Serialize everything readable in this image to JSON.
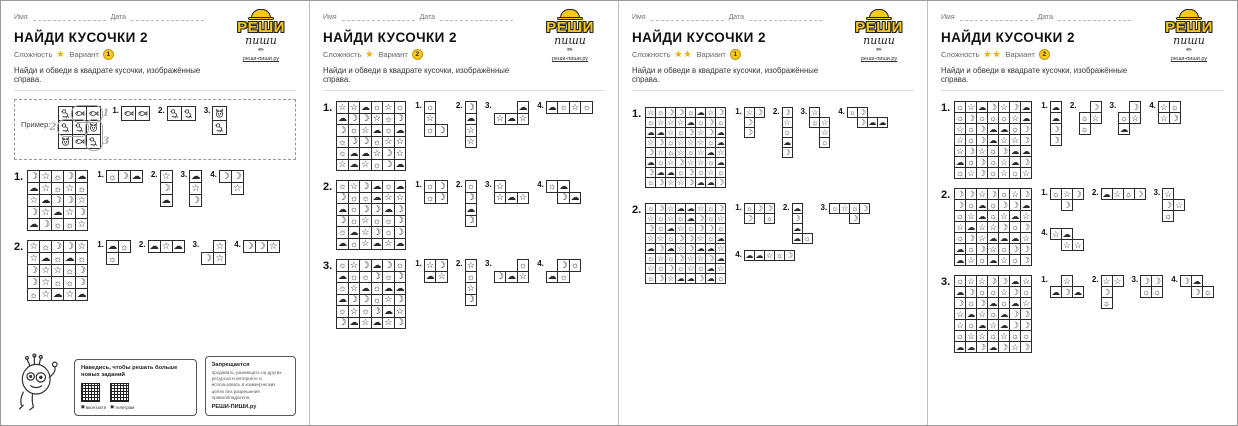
{
  "symbol_chars": {
    "M": "☽",
    "S": "☆",
    "U": "☼",
    "C": "☁"
  },
  "symbol_names": {
    "M": "moon-icon",
    "S": "star-icon",
    "U": "sun-icon",
    "C": "cloud-icon",
    "B": "bird-icon",
    "F": "fish-icon",
    "K": "cat-icon"
  },
  "logo": {
    "line1": "РЕШИ",
    "line2": "пиши",
    "site": "реши-пиши.ру"
  },
  "footer": {
    "promo_title": "Наведись, чтобы решать больше новых заданий",
    "qr1_label": "вконтакте",
    "qr2_label": "телеграм",
    "rights_title": "Запрещается",
    "rights_text": "продавать, размещать на других ресурсах в интернете и использовать в коммерческих целях без разрешения правообладателя.",
    "rights_brand": "РЕШИ-ПИШИ.ру"
  },
  "pages": [
    {
      "name_label": "Имя",
      "date_label": "Дата",
      "title": "НАЙДИ КУСОЧКИ 2",
      "difficulty_label": "Сложность",
      "difficulty_stars": "★",
      "variant_label": "Вариант",
      "variant": "1",
      "instruction": "Найди и обведи в квадрате кусочки, изображённые справа.",
      "example": {
        "label": "Пример:",
        "grid": [
          "BFF",
          "BBK",
          "KFB"
        ],
        "pieces": [
          {
            "n": "1.",
            "rows": [
              "FF"
            ]
          },
          {
            "n": "2.",
            "rows": [
              "BB"
            ]
          },
          {
            "n": "3.",
            "rows": [
              "K",
              "B"
            ]
          }
        ],
        "circles": [
          {
            "r": 0,
            "c": 1,
            "w": 2,
            "h": 1,
            "label": "1",
            "side": "right"
          },
          {
            "r": 1,
            "c": 0,
            "w": 2,
            "h": 1,
            "label": "2",
            "side": "left"
          },
          {
            "r": 1,
            "c": 2,
            "w": 1,
            "h": 2,
            "label": "3",
            "side": "right"
          }
        ]
      },
      "has_footer": true,
      "puzzles": [
        {
          "n": "1.",
          "grid": [
            "MSUMC",
            "CSUSU",
            "SCMMS",
            "MSCSM",
            "CMUUS"
          ],
          "pieces": [
            {
              "n": "1.",
              "rows": [
                "UMC"
              ]
            },
            {
              "n": "2.",
              "rows": [
                "S",
                "M",
                "C"
              ]
            },
            {
              "n": "3.",
              "rows": [
                "C",
                "S",
                "M"
              ]
            },
            {
              "n": "4.",
              "rows": [
                "MM",
                ".S"
              ]
            }
          ]
        },
        {
          "n": "2.",
          "grid": [
            "SUMMS",
            "SCUCU",
            "MSSUM",
            "MSUUM",
            "USCSC"
          ],
          "pieces": [
            {
              "n": "1.",
              "rows": [
                "CU",
                "U."
              ]
            },
            {
              "n": "2.",
              "rows": [
                "CSC"
              ]
            },
            {
              "n": "3.",
              "rows": [
                ".S",
                "MS"
              ]
            },
            {
              "n": "4.",
              "rows": [
                "MMS"
              ]
            }
          ]
        }
      ]
    },
    {
      "name_label": "Имя",
      "date_label": "Дата",
      "title": "НАЙДИ КУСОЧКИ 2",
      "difficulty_label": "Сложность",
      "difficulty_stars": "★",
      "variant_label": "Вариант",
      "variant": "2",
      "instruction": "Найди и обведи в квадрате кусочки, изображённые справа.",
      "has_footer": false,
      "puzzles": [
        {
          "n": "1.",
          "grid": [
            "SSCUSU",
            "CMMSUM",
            "MUSCUC",
            "UMMUSS",
            "UCCSMS",
            "SCSUMC"
          ],
          "pieces": [
            {
              "n": "1.",
              "rows": [
                "U.",
                "S.",
                "UM"
              ]
            },
            {
              "n": "2.",
              "rows": [
                "M",
                "C",
                "S",
                "S"
              ]
            },
            {
              "n": "3.",
              "rows": [
                "..C",
                "SCS"
              ]
            },
            {
              "n": "4.",
              "rows": [
                "CUSU"
              ]
            }
          ]
        },
        {
          "n": "2.",
          "grid": [
            "USMCUC",
            "MUUCSS",
            "CUMMCM",
            "MUSUUM",
            "UCSMUM",
            "CUSCSC"
          ],
          "pieces": [
            {
              "n": "1.",
              "rows": [
                "UM",
                "UM"
              ]
            },
            {
              "n": "2.",
              "rows": [
                "U",
                "M",
                "C",
                "M"
              ]
            },
            {
              "n": "3.",
              "rows": [
                "S..",
                "SCS"
              ]
            },
            {
              "n": "4.",
              "rows": [
                "UC.",
                ".MC"
              ]
            }
          ]
        },
        {
          "n": "3.",
          "grid": [
            "USMCMU",
            "CUUMUM",
            "USCUCC",
            "CMMUSM",
            "USUMCS",
            "MCSCSM"
          ],
          "pieces": [
            {
              "n": "1.",
              "rows": [
                "SM",
                "CS"
              ]
            },
            {
              "n": "2.",
              "rows": [
                "S",
                "U",
                "S",
                "M"
              ]
            },
            {
              "n": "3.",
              "rows": [
                "..U",
                "MCS"
              ]
            },
            {
              "n": "4.",
              "rows": [
                ".MU",
                "CU."
              ]
            }
          ]
        }
      ]
    },
    {
      "name_label": "Имя",
      "date_label": "Дата",
      "title": "НАЙДИ КУСОЧКИ 2",
      "difficulty_label": "Сложность",
      "difficulty_stars": "★★",
      "variant_label": "Вариант",
      "variant": "1",
      "instruction": "Найди и обведи в квадрате кусочки, изображённые справа.",
      "has_footer": false,
      "puzzles": [
        {
          "n": "1.",
          "grid": [
            "SUMMUCSM",
            "USSSCUMU",
            "CCSUMSMC",
            "SMUSSSUC",
            "MSUSUSCS",
            "CUSMSSUC",
            "MCCUMUSU",
            "UMSSMCCM"
          ],
          "pieces": [
            {
              "n": "1.",
              "rows": [
                "SM",
                "M.",
                "M."
              ]
            },
            {
              "n": "2.",
              "rows": [
                "M",
                "S",
                "U",
                "C",
                "M"
              ]
            },
            {
              "n": "3.",
              "rows": [
                "S.",
                "US",
                ".S",
                ".U"
              ]
            },
            {
              "n": "4.",
              "rows": [
                "UM..",
                ".MCC"
              ]
            }
          ]
        },
        {
          "n": "2.",
          "grid": [
            "UMSCCSUM",
            "SUSUCMUS",
            "MUCSUMMU",
            "SSUMMSUC",
            "CMCSMCCS",
            "USUMSSMC",
            "SUMUSUCS",
            "UMSCCMCU"
          ],
          "pieces": [
            {
              "n": "1.",
              "rows": [
                "UMM",
                "M.U"
              ]
            },
            {
              "n": "2.",
              "rows": [
                "C.",
                "M.",
                "C.",
                "CU"
              ]
            },
            {
              "n": "3.",
              "rows": [
                "USUM",
                "..M."
              ]
            },
            {
              "n": "4.",
              "rows": [
                "CCSUM"
              ]
            }
          ]
        }
      ]
    },
    {
      "name_label": "Имя",
      "date_label": "Дата",
      "title": "НАЙДИ КУСОЧКИ 2",
      "difficulty_label": "Сложность",
      "difficulty_stars": "★★",
      "variant_label": "Вариант",
      "variant": "2",
      "instruction": "Найди и обведи в квадрате кусочки, изображённые справа.",
      "has_footer": false,
      "puzzles": [
        {
          "n": "1.",
          "grid": [
            "USCMSMC",
            "UMUUUSC",
            "SUMCCUM",
            "SUMCSSM",
            "SMSUMCC",
            "CUMUSCM",
            "USMUSUS"
          ],
          "pieces": [
            {
              "n": "1.",
              "rows": [
                "C",
                "C",
                "M",
                "M"
              ]
            },
            {
              "n": "2.",
              "rows": [
                ".M",
                "US",
                "U."
              ]
            },
            {
              "n": "3.",
              "rows": [
                ".M",
                "US",
                "C."
              ]
            },
            {
              "n": "4.",
              "rows": [
                "SU",
                "SM"
              ]
            }
          ]
        },
        {
          "n": "2.",
          "grid": [
            "MMSMUSM",
            "MUCUMMC",
            "USCUSCS",
            "SCSSMUM",
            "UMSCCCS",
            "CUMSUMM",
            "CSUCSUM"
          ],
          "pieces": [
            {
              "n": "1.",
              "rows": [
                "USM",
                ".M."
              ]
            },
            {
              "n": "2.",
              "rows": [
                "CSUM"
              ]
            },
            {
              "n": "3.",
              "rows": [
                "S.",
                "MS",
                "U."
              ]
            },
            {
              "n": "4.",
              "rows": [
                "SC.",
                ".SS"
              ]
            }
          ]
        },
        {
          "n": "3.",
          "grid": [
            "USSMMCS",
            "CMUUSMU",
            "MUMCUCS",
            "SCSUCMM",
            "SUCSCMM",
            "USSUSUU",
            "CCMCMSM"
          ],
          "pieces": [
            {
              "n": "1.",
              "rows": [
                ".S.",
                "CMC"
              ]
            },
            {
              "n": "2.",
              "rows": [
                "SS",
                "M.",
                "U."
              ]
            },
            {
              "n": "3.",
              "rows": [
                "MM",
                "UU"
              ]
            },
            {
              "n": "4.",
              "rows": [
                "MC.",
                ".MU"
              ]
            }
          ]
        }
      ]
    }
  ]
}
